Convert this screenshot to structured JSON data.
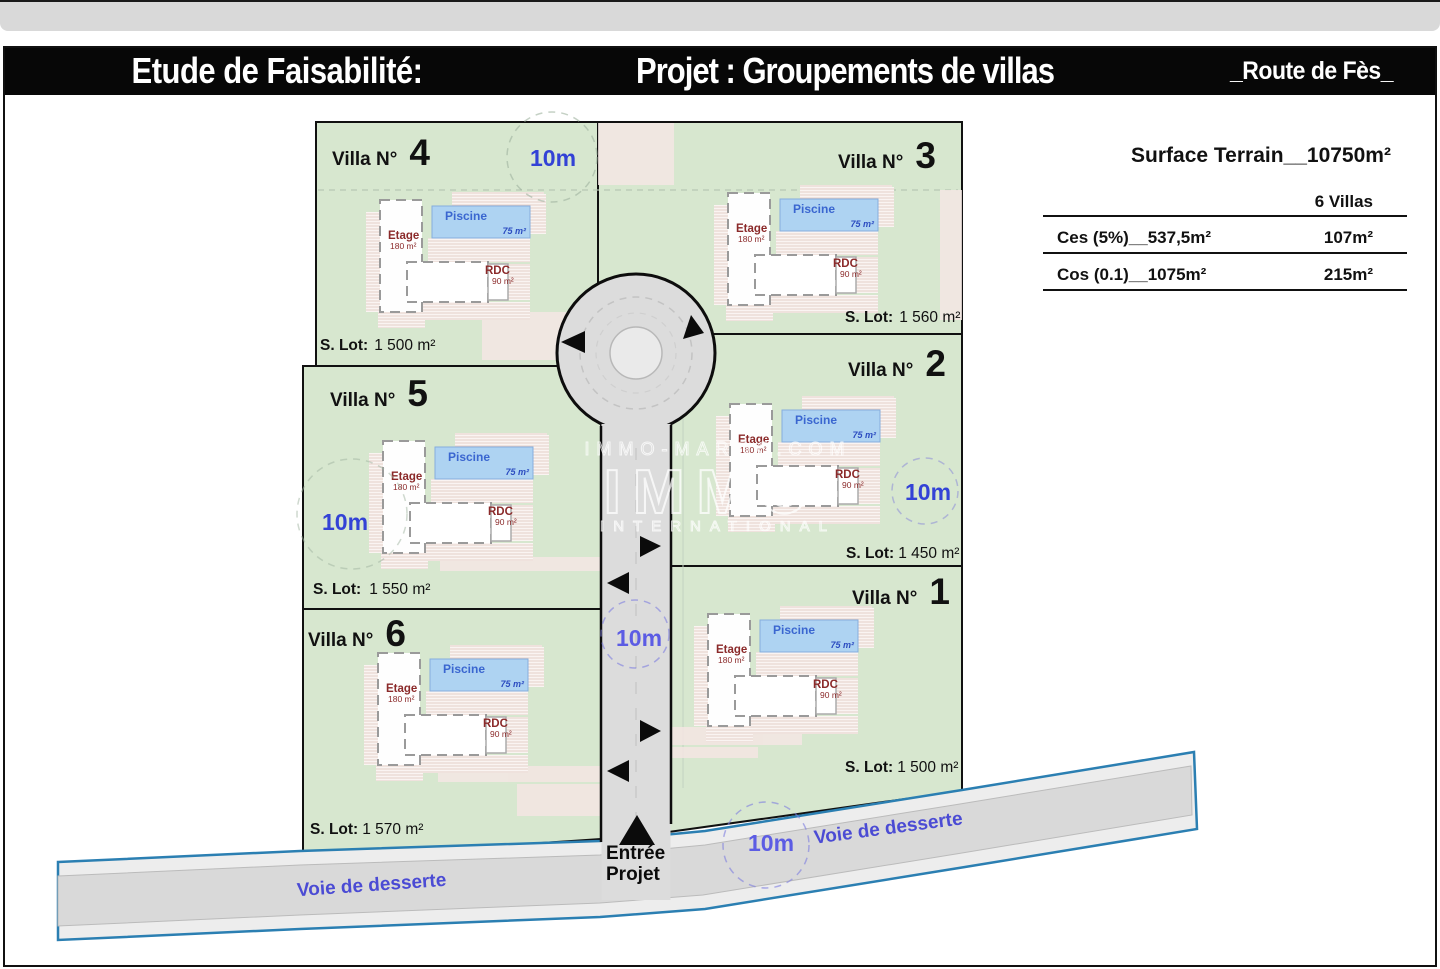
{
  "header": {
    "study_title": "Etude de Faisabilité:",
    "project_title": "Projet : Groupements de villas",
    "location": "_Route de Fès_"
  },
  "summary": {
    "title": "Surface Terrain__10750m²",
    "column_header": "6 Villas",
    "rows": [
      {
        "label": "Ces (5%)__537,5m²",
        "value": "107m²"
      },
      {
        "label": "Cos (0.1)__1075m²",
        "value": "215m²"
      }
    ]
  },
  "plan": {
    "villa_label_prefix": "Villa N°",
    "lot_label_prefix": "S. Lot:",
    "width_label": "10m",
    "service_road_label": "Voie de desserte",
    "entrance": {
      "line1": "Entrée",
      "line2": "Projet"
    },
    "house": {
      "pool_label": "Piscine",
      "pool_area": "75 m²",
      "upper_floor_label": "Etage",
      "upper_floor_area": "180 m²",
      "ground_floor_label": "RDC",
      "ground_floor_area": "90 m²"
    },
    "villas": [
      {
        "number": "1",
        "lot_area": "1 500 m²"
      },
      {
        "number": "2",
        "lot_area": "1 450 m²"
      },
      {
        "number": "3",
        "lot_area": "1 560 m²"
      },
      {
        "number": "4",
        "lot_area": "1 500 m²"
      },
      {
        "number": "5",
        "lot_area": "1 550 m²"
      },
      {
        "number": "6",
        "lot_area": "1 570 m²"
      }
    ]
  },
  "watermark": {
    "line1": "IMMO-MAROC.COM",
    "line2": "IMMO",
    "line3": "INTERNATIONAL"
  },
  "colors": {
    "lot_green": "#d7e7cf",
    "road_gray": "#dcdcdc",
    "road_edge_teal": "#2b7fb2",
    "pool_blue": "#aed3f2",
    "dimension_blue": "#3342d6",
    "road_label_purple": "#4b4bd4",
    "floor_text_maroon": "#8b2a2a"
  }
}
